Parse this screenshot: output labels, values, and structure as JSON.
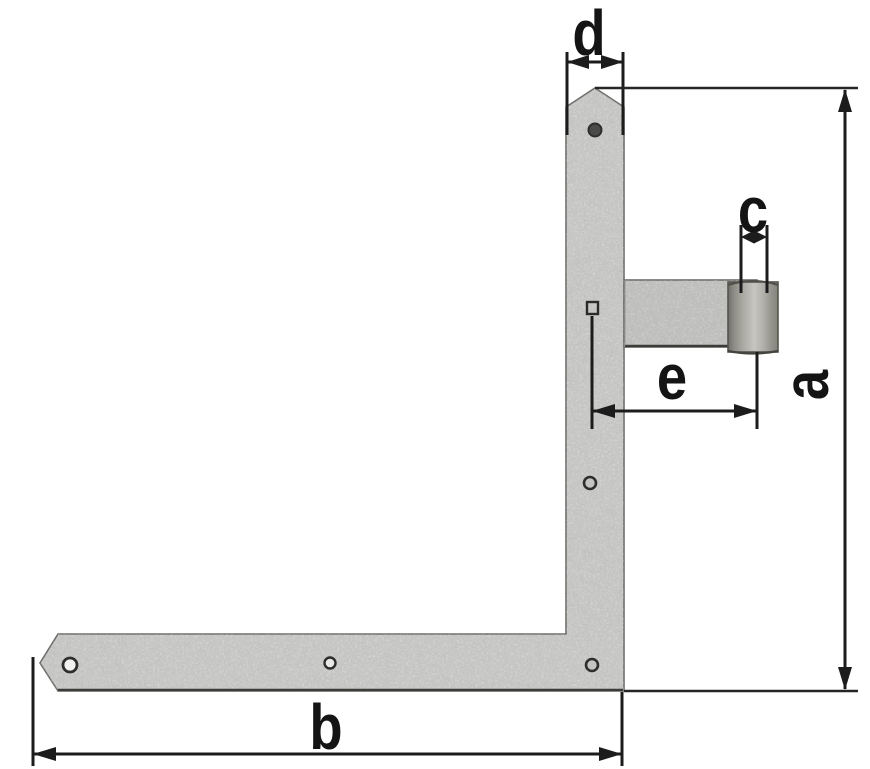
{
  "figure": {
    "kind": "technical dimension drawing",
    "subject": "L-shaped corner gate hinge (angle band hinge) with hinge pin barrel",
    "background": "#ffffff"
  },
  "dimension_labels": {
    "a": "a",
    "b": "b",
    "c": "c",
    "d": "d",
    "e": "e"
  },
  "dimensions_legend": [
    {
      "id": "a",
      "label": "a",
      "measures": "overall height, right side"
    },
    {
      "id": "b",
      "label": "b",
      "measures": "overall width, bottom"
    },
    {
      "id": "c",
      "label": "c",
      "measures": "hinge barrel / pin diameter"
    },
    {
      "id": "d",
      "label": "d",
      "measures": "vertical strap width, top"
    },
    {
      "id": "e",
      "label": "e",
      "measures": "offset from strap to barrel centre"
    }
  ],
  "colors": {
    "background": "#ffffff",
    "metal": "#c8c8c6",
    "metal_band": "#c1c1bf",
    "barrel_light": "#c6c5bf",
    "barrel_dark": "#77766f",
    "outline": "#6e6e6c",
    "edge_dark": "#3c3c3a",
    "annotation": "#141414"
  }
}
